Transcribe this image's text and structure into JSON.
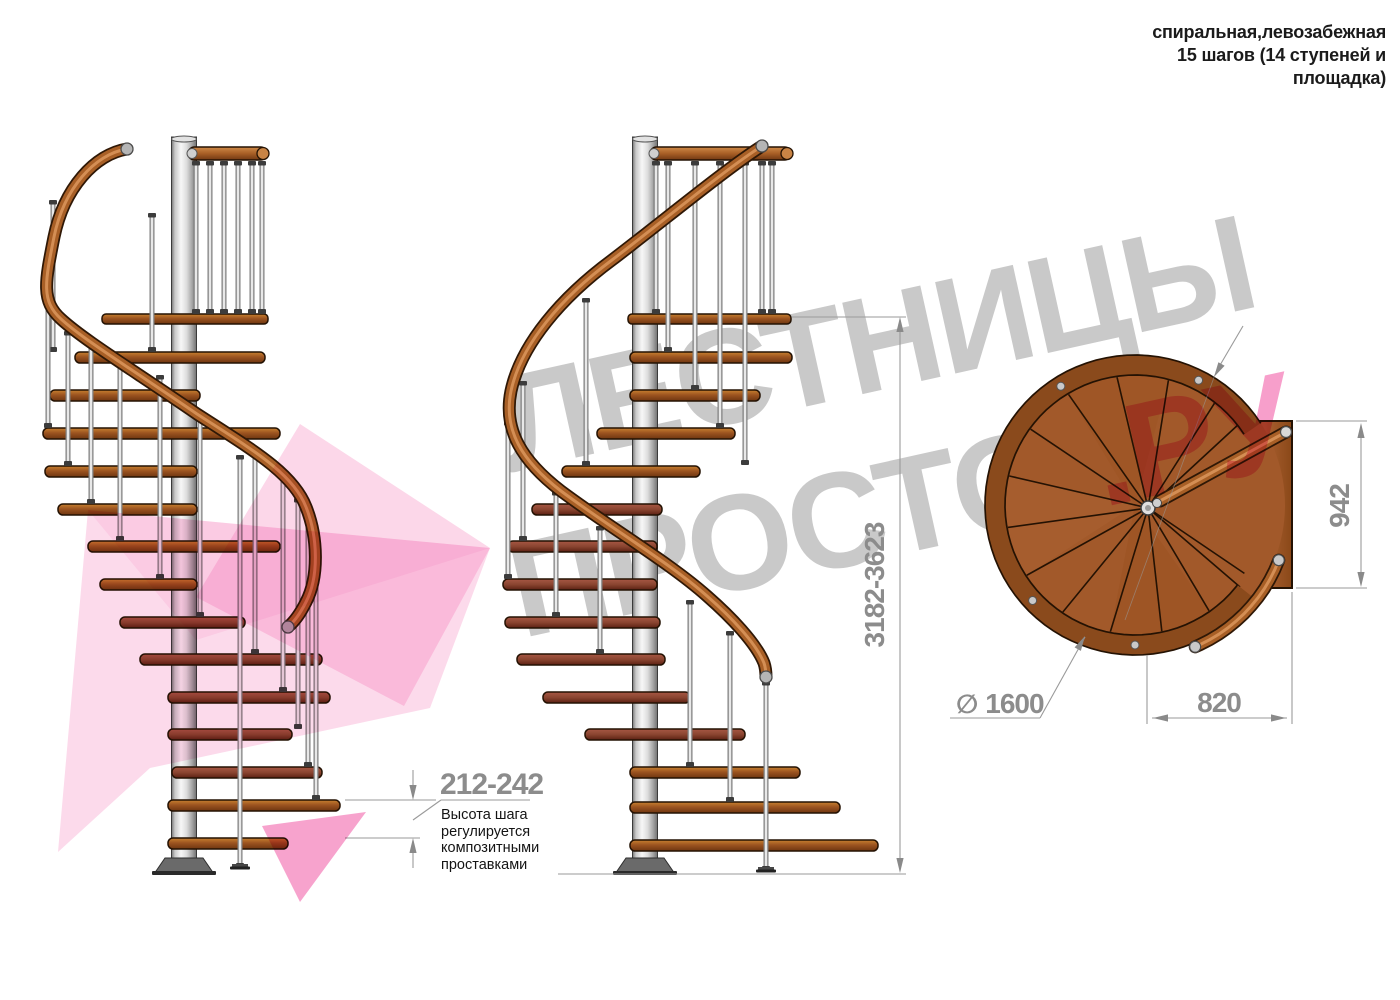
{
  "title": {
    "line1": "спиральная,левозабежная",
    "line2": "15 шагов (14 ступеней и",
    "line3": "площадка)"
  },
  "watermark": {
    "line1": "ЛЕСТНИЦЫ",
    "line2": "ПРОСТО",
    "line3": ".РУ",
    "gray": "#c9c9c9",
    "pink": "#f0479b"
  },
  "dims": {
    "step_height": {
      "value": "212-242",
      "note": "Высота шага\nрегулируется\nкомпозитными\nпроставками"
    },
    "total_height": {
      "value": "3182-3623"
    },
    "platform_width": {
      "value": "942"
    },
    "landing_depth": {
      "value": "820"
    },
    "diameter": {
      "symbol": "∅",
      "value": "1600"
    }
  },
  "colors": {
    "outline": "#241203",
    "wood_top": "#c8812f",
    "wood_mid": "#9c5420",
    "wood_dark": "#6e3610",
    "wood_maroon_top": "#a85744",
    "wood_maroon_dark": "#5c2013",
    "rail_dark": "#2f1806",
    "rail_mid": "#a85f26",
    "rail_hi": "#d8945a",
    "steel_hi": "#f5f5f5",
    "steel_mid": "#c0c0c0",
    "steel_dark": "#6f6f6f",
    "dimline": "#9a9a9a",
    "dimtext": "#8c8c8c",
    "tread": "#a2592a",
    "rim": "#8a4a1c"
  },
  "drawing": {
    "stairs": [
      {
        "id": "left",
        "column": {
          "cx": 184,
          "w": 25,
          "top": 137,
          "bottom": 858
        },
        "platform": {
          "x": 102,
          "y": 314,
          "w": 166
        },
        "toprail": {
          "x": 188,
          "y": 147,
          "w": 79
        },
        "prods": [
          [
            196,
            161,
            314
          ],
          [
            210,
            161,
            314
          ],
          [
            224,
            161,
            314
          ],
          [
            238,
            161,
            314
          ],
          [
            252,
            161,
            314
          ],
          [
            262,
            161,
            314
          ]
        ],
        "steps": [
          [
            75,
            352,
            265
          ],
          [
            50,
            390,
            200
          ],
          [
            43,
            428,
            280
          ],
          [
            45,
            466,
            197
          ],
          [
            58,
            504,
            197
          ],
          [
            88,
            541,
            280
          ],
          [
            100,
            579,
            197
          ],
          [
            120,
            617,
            245,
            "d"
          ],
          [
            140,
            654,
            322,
            "d"
          ],
          [
            168,
            692,
            330,
            "d"
          ],
          [
            168,
            729,
            292,
            "d"
          ],
          [
            172,
            767,
            322,
            "d"
          ],
          [
            168,
            800,
            340
          ],
          [
            168,
            838,
            288
          ]
        ],
        "rods": [
          [
            152,
            213,
            352
          ],
          [
            53,
            200,
            352
          ],
          [
            48,
            262,
            428
          ],
          [
            68,
            331,
            466
          ],
          [
            91,
            343,
            504
          ],
          [
            120,
            357,
            541
          ],
          [
            160,
            375,
            579
          ],
          [
            200,
            414,
            617
          ],
          [
            240,
            455,
            868,
            "foot"
          ],
          [
            255,
            450,
            654
          ],
          [
            283,
            473,
            692
          ],
          [
            298,
            498,
            729
          ],
          [
            308,
            516,
            767
          ],
          [
            316,
            552,
            800
          ]
        ],
        "handrail": "M127,149 C95,154 64,188 54,237 C45,282 41,301 61,319 C84,340 130,368 197,414 C251,449 293,473 306,507 C318,537 319,577 306,602 C300,614 295,621 288,627",
        "caps": [
          [
            127,
            149
          ],
          [
            288,
            627
          ]
        ]
      },
      {
        "id": "middle",
        "column": {
          "cx": 645,
          "w": 25,
          "top": 137,
          "bottom": 858
        },
        "platform": {
          "x": 628,
          "y": 314,
          "w": 163
        },
        "toprail": {
          "x": 650,
          "y": 147,
          "w": 141
        },
        "prods": [
          [
            656,
            161,
            314
          ],
          [
            668,
            161,
            352
          ],
          [
            695,
            161,
            390
          ],
          [
            720,
            161,
            428
          ],
          [
            745,
            161,
            465
          ],
          [
            762,
            161,
            314
          ],
          [
            772,
            161,
            314
          ]
        ],
        "steps": [
          [
            630,
            352,
            792
          ],
          [
            630,
            390,
            760
          ],
          [
            597,
            428,
            735
          ],
          [
            562,
            466,
            700
          ],
          [
            532,
            504,
            662,
            "d"
          ],
          [
            508,
            541,
            657,
            "d"
          ],
          [
            503,
            579,
            657,
            "d"
          ],
          [
            505,
            617,
            660,
            "d"
          ],
          [
            517,
            654,
            665,
            "d"
          ],
          [
            543,
            692,
            690,
            "d"
          ],
          [
            585,
            729,
            745,
            "d"
          ],
          [
            630,
            767,
            800
          ],
          [
            630,
            802,
            840
          ],
          [
            630,
            840,
            878
          ]
        ],
        "rods": [
          [
            586,
            298,
            466
          ],
          [
            523,
            381,
            541
          ],
          [
            508,
            421,
            579
          ],
          [
            556,
            491,
            617
          ],
          [
            600,
            526,
            654
          ],
          [
            690,
            600,
            767
          ],
          [
            730,
            631,
            802
          ],
          [
            766,
            681,
            871,
            "foot"
          ]
        ],
        "handrail": "M762,146 C727,168 662,222 612,260 C562,297 521,344 511,391 C503,430 522,461 561,491 C612,529 670,563 707,596 C731,617 756,643 764,663 C766,669 766,673 766,677",
        "caps": [
          [
            762,
            146
          ],
          [
            766,
            677
          ]
        ]
      }
    ],
    "topview": {
      "center": [
        1135,
        505
      ],
      "r_tread": 150,
      "r_rim_mid": 140,
      "rim_w": 20,
      "rim_arc": [
        33,
        322
      ],
      "platform": [
        1237,
        421,
        55,
        167
      ],
      "hub": [
        1148,
        508
      ],
      "wedge_angles": [
        52,
        75,
        98,
        121,
        144,
        167,
        190,
        213,
        236,
        259,
        282,
        305,
        328
      ],
      "corner_lines": [
        [
          1240,
          423
        ],
        [
          1240,
          587
        ]
      ],
      "shade_sectors": [
        [
          75,
          121,
          "#9b5322",
          0.5
        ],
        [
          167,
          213,
          "#aa6132",
          0.5
        ],
        [
          259,
          305,
          "#985020",
          0.45
        ]
      ],
      "sockets": [
        63,
        122,
        223,
        270
      ],
      "rail_line": [
        1160,
        501,
        1286,
        432
      ],
      "rail_connector": [
        1157,
        503
      ],
      "rail_cap": [
        1286,
        432
      ],
      "arc_rail": {
        "r": 154,
        "a1": -21,
        "a2": -67
      }
    },
    "dimgeo": {
      "lines": [
        [
          792,
          317,
          906,
          317,
          1.1,
          1
        ],
        [
          558,
          874,
          906,
          874,
          1.1,
          1
        ],
        [
          900,
          320,
          900,
          871,
          1.1,
          1
        ],
        [
          345,
          800,
          436,
          800,
          1.1,
          1
        ],
        [
          345,
          838,
          420,
          838,
          1.1,
          1
        ],
        [
          413,
          770,
          413,
          797,
          1.1,
          1
        ],
        [
          413,
          841,
          413,
          868,
          1.1,
          1
        ],
        [
          441,
          800,
          530,
          800,
          1.1,
          1
        ],
        [
          441,
          800,
          413,
          820,
          1.1,
          1
        ],
        [
          1296,
          421,
          1367,
          421,
          1.1,
          1
        ],
        [
          1296,
          588,
          1367,
          588,
          1.1,
          1
        ],
        [
          1361,
          425,
          1361,
          585,
          1.1,
          1
        ],
        [
          1147,
          655,
          1147,
          724,
          1.1,
          1
        ],
        [
          1292,
          592,
          1292,
          724,
          1.1,
          1
        ],
        [
          1152,
          718,
          1287,
          718,
          1.1,
          1
        ],
        [
          950,
          718,
          1040,
          718,
          1.1,
          1
        ],
        [
          1040,
          718,
          1085,
          637,
          1.1,
          1
        ],
        [
          1243,
          326,
          1216,
          372,
          1.1,
          1
        ],
        [
          1216,
          372,
          1125,
          620,
          0.8,
          0.6
        ]
      ],
      "arrows": [
        [
          900,
          317,
          90
        ],
        [
          900,
          873,
          270
        ],
        [
          413,
          800,
          270
        ],
        [
          413,
          838,
          90
        ],
        [
          1361,
          423,
          90
        ],
        [
          1361,
          587,
          270
        ],
        [
          1153,
          718,
          180
        ],
        [
          1286,
          718,
          0
        ],
        [
          1085,
          636,
          61
        ],
        [
          1214,
          377,
          240
        ]
      ]
    },
    "pink_logo": [
      {
        "pts": [
          [
            88,
            510
          ],
          [
            490,
            548
          ],
          [
            430,
            708
          ],
          [
            150,
            768
          ],
          [
            58,
            852
          ]
        ],
        "op": 0.2
      },
      {
        "pts": [
          [
            300,
            424
          ],
          [
            490,
            548
          ],
          [
            404,
            706
          ],
          [
            196,
            597
          ]
        ],
        "op": 0.22
      },
      {
        "pts": [
          [
            88,
            510
          ],
          [
            490,
            548
          ],
          [
            196,
            640
          ]
        ],
        "op": 0.1
      },
      {
        "pts": [
          [
            262,
            826
          ],
          [
            366,
            812
          ],
          [
            300,
            902
          ]
        ],
        "op": 0.5
      }
    ]
  }
}
